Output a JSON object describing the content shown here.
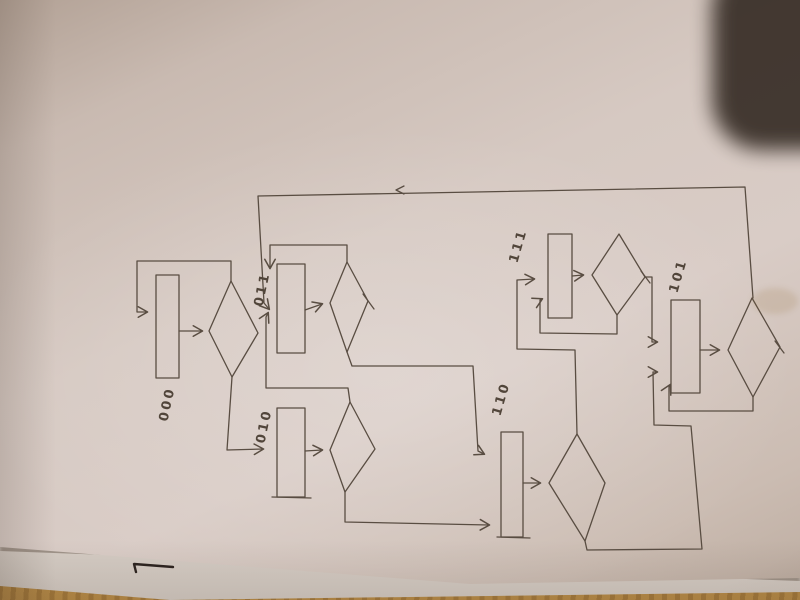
{
  "scene": {
    "description": "photo of hand-drawn state-machine flowchart in pencil on paper",
    "ink_color": "#594d42",
    "label_color": "#51453a",
    "paper_color": "#d6c9c2",
    "paper_edge_color": "#b2a195",
    "under_sheet_color": "#ded6cf",
    "table_wood_color": "#c99e60",
    "dark_object_color": "#3a3029",
    "pen_mark_color": "#2c2420"
  },
  "diagram": {
    "nodes": [
      {
        "id": "000",
        "label": "000",
        "rect": [
          156,
          275,
          23,
          103
        ],
        "label_pos": [
          171,
          405
        ],
        "label_rotation": -78
      },
      {
        "id": "011",
        "label": "011",
        "rect": [
          277,
          264,
          28,
          89
        ],
        "label_pos": [
          266,
          290
        ],
        "label_rotation": -78
      },
      {
        "id": "010",
        "label": "010",
        "rect": [
          277,
          408,
          28,
          89
        ],
        "label_pos": [
          268,
          427
        ],
        "label_rotation": -78
      },
      {
        "id": "110",
        "label": "110",
        "rect": [
          501,
          432,
          22,
          105
        ],
        "label_pos": [
          505,
          400
        ],
        "label_rotation": -74
      },
      {
        "id": "111",
        "label": "111",
        "rect": [
          548,
          234,
          24,
          84
        ],
        "label_pos": [
          522,
          247
        ],
        "label_rotation": -74
      },
      {
        "id": "101",
        "label": "101",
        "rect": [
          671,
          300,
          29,
          93
        ],
        "label_pos": [
          682,
          277
        ],
        "label_rotation": -74
      }
    ],
    "diamonds": [
      {
        "state": "000",
        "points": "209,331 231,281 258,333 232,377"
      },
      {
        "state": "011",
        "points": "330,303 347,262 368,301 347,352"
      },
      {
        "state": "010",
        "points": "330,450 350,402 375,449 345,492"
      },
      {
        "state": "110",
        "points": "549,483 577,434 605,483 585,541"
      },
      {
        "state": "111",
        "points": "592,275 619,234 645,277 617,315"
      },
      {
        "state": "101",
        "points": "728,350 752,298 780,347 753,397"
      }
    ],
    "edges": [
      {
        "name": "101-top-return-to-011",
        "path": "M753,298 L745,187 L258,196 L264,303 L269,309",
        "arrow": true
      },
      {
        "name": "000-to-decision",
        "path": "M179,331 L202,331",
        "arrow": true
      },
      {
        "name": "000-self-loop",
        "path": "M231,281 L231,261 L137,261 L137,312 L147,312",
        "arrow": true
      },
      {
        "name": "000-to-010",
        "path": "M232,377 L227,450 L263,449",
        "arrow": true
      },
      {
        "name": "011-to-decision",
        "path": "M305,310 L322,304",
        "arrow": true
      },
      {
        "name": "011-self-loop",
        "path": "M347,262 L347,245 L270,245 L270,268",
        "arrow": true
      },
      {
        "name": "011-to-110",
        "path": "M347,352 L352,366 L473,366 L478,451 L484,454",
        "arrow": true
      },
      {
        "name": "010-to-decision",
        "path": "M305,451 L322,450",
        "arrow": true
      },
      {
        "name": "010-to-011",
        "path": "M350,402 L348,388 L266,388 L266,317 L268,313",
        "arrow": true
      },
      {
        "name": "010-to-110",
        "path": "M345,492 L345,522 L489,525",
        "arrow": true
      },
      {
        "name": "110-to-decision",
        "path": "M523,483 L540,483",
        "arrow": true
      },
      {
        "name": "110-to-111",
        "path": "M577,434 L575,350 L517,349 L517,280 L534,279",
        "arrow": true
      },
      {
        "name": "110-to-101",
        "path": "M585,541 L587,550 L702,549 L691,426 L654,425 L653,372 L657,372",
        "arrow": true
      },
      {
        "name": "111-to-decision",
        "path": "M572,276 L583,275",
        "arrow": true
      },
      {
        "name": "111-self-loop",
        "path": "M617,315 L617,334 L540,333 L540,300 L542,299",
        "arrow": true
      },
      {
        "name": "111-to-101",
        "path": "M645,277 L652,277 L652,342 L657,342",
        "arrow": true
      },
      {
        "name": "101-to-decision",
        "path": "M700,350 L719,350",
        "arrow": true
      },
      {
        "name": "101-self-loop",
        "path": "M753,397 L753,411 L669,411 L669,387 L670,385",
        "arrow": true
      }
    ],
    "marks": [
      {
        "name": "top-line-arrow-tick",
        "path": "M404,186 L396,190 L404,194"
      },
      {
        "name": "overshoot-011-right-vertex",
        "path": "M363,294 L374,309"
      },
      {
        "name": "overshoot-101-right-vertex",
        "path": "M775,341 L784,353"
      },
      {
        "name": "overshoot-111-right-vertex",
        "path": "M641,271 L650,283"
      },
      {
        "name": "overshoot-110-rect-bottom",
        "path": "M497,537 L530,538"
      },
      {
        "name": "overshoot-010-rect-bottom",
        "path": "M272,497 L311,498"
      }
    ],
    "pen_mark_path": "M136,572 L134,564 L173,567"
  }
}
